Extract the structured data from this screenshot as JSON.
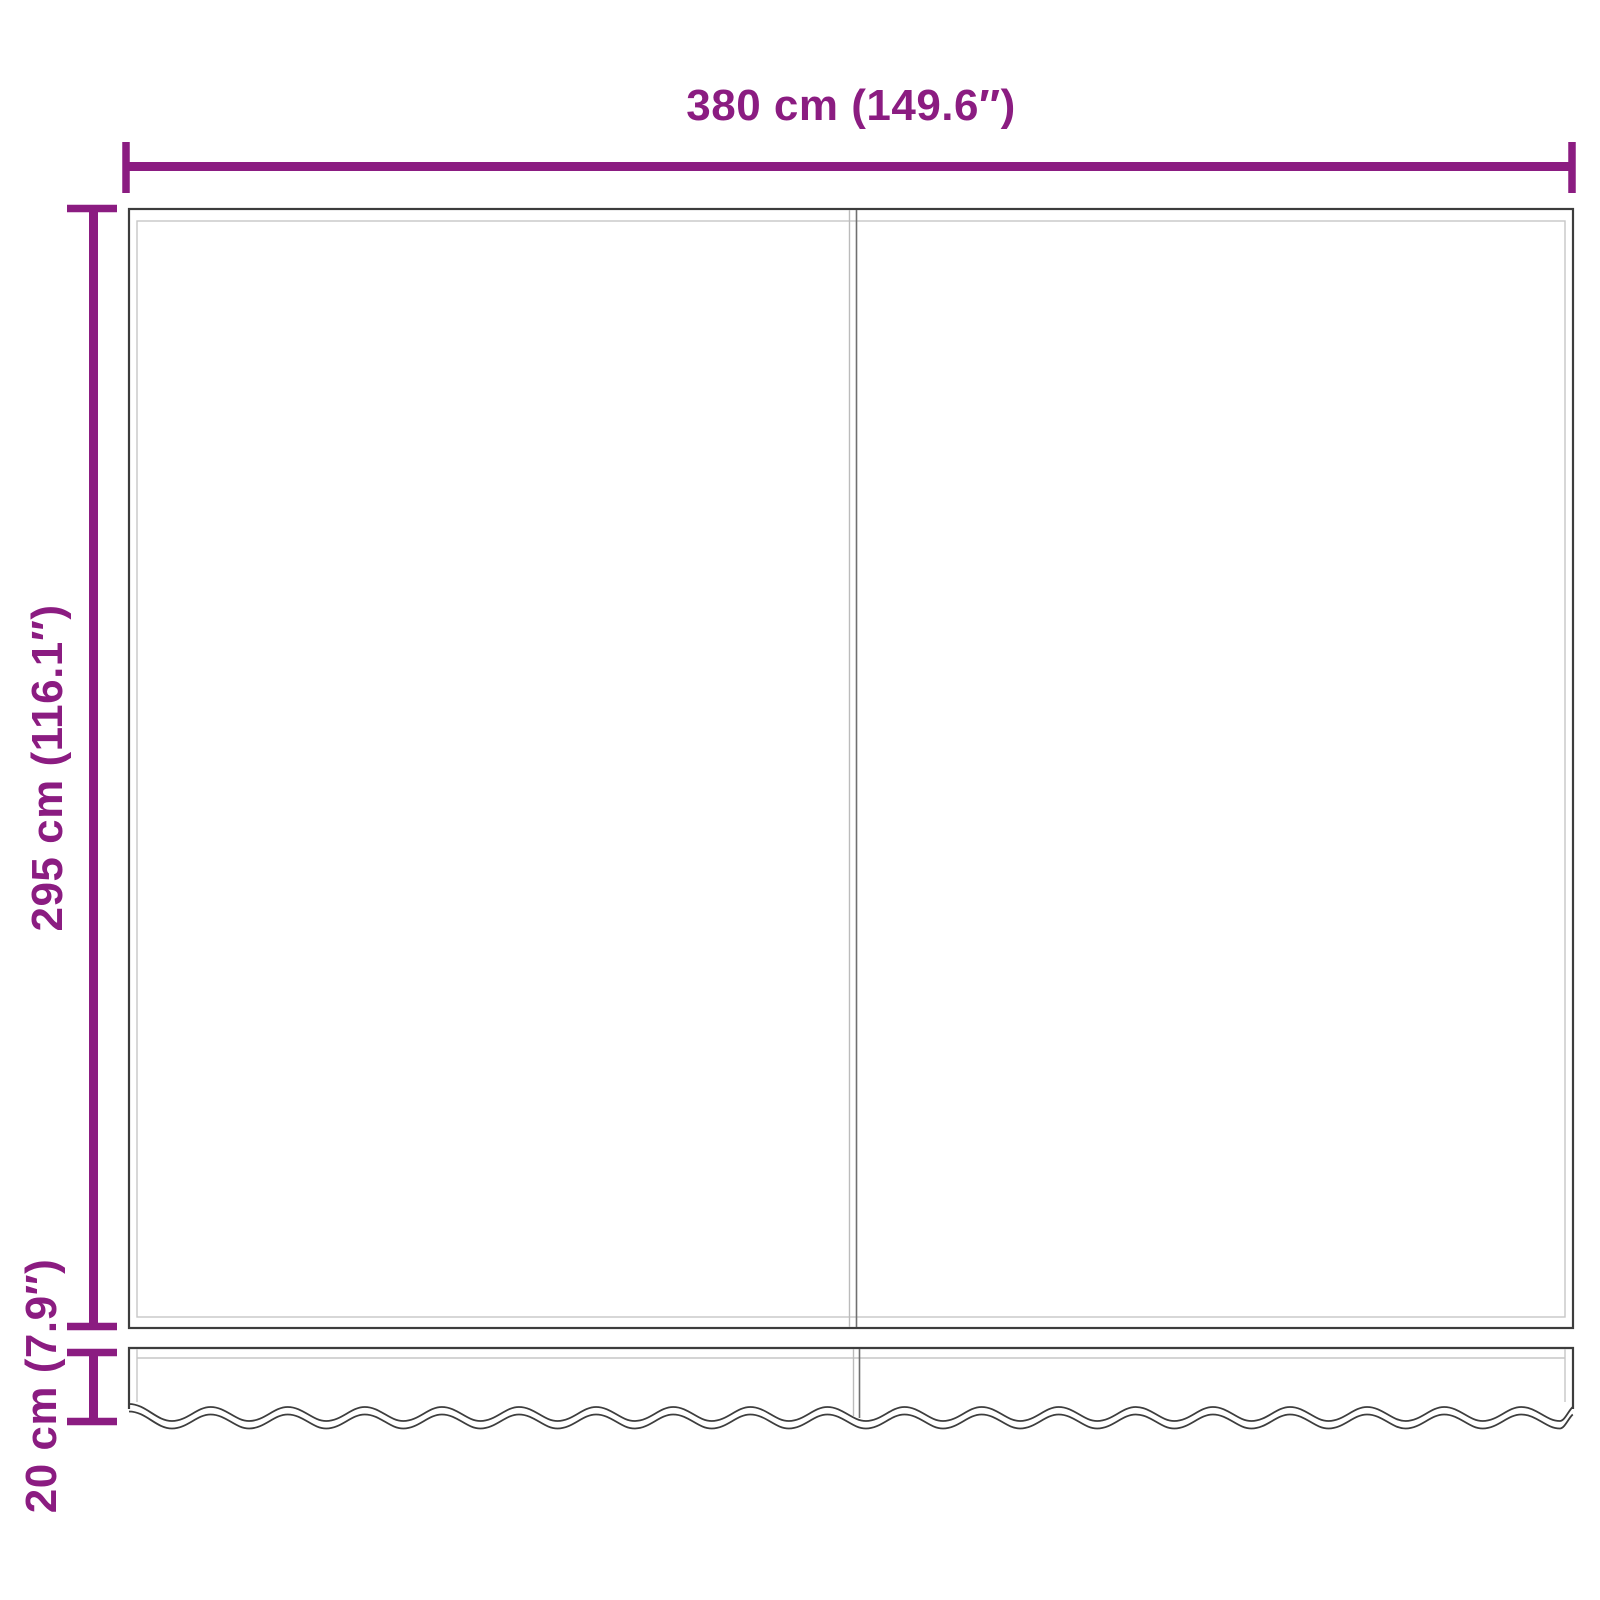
{
  "page": {
    "background": "#ffffff"
  },
  "colors": {
    "dimension": "#8B1C81",
    "outline": "#3d3d3d",
    "hem": "#c6c6c6",
    "seam_light": "#bbbbbb",
    "seam_dark": "#707070"
  },
  "dimensions": {
    "width_label": "380 cm (149.6″)",
    "height_label": "295 cm (116.1″)",
    "valance_label": "20 cm (7.9″)"
  }
}
